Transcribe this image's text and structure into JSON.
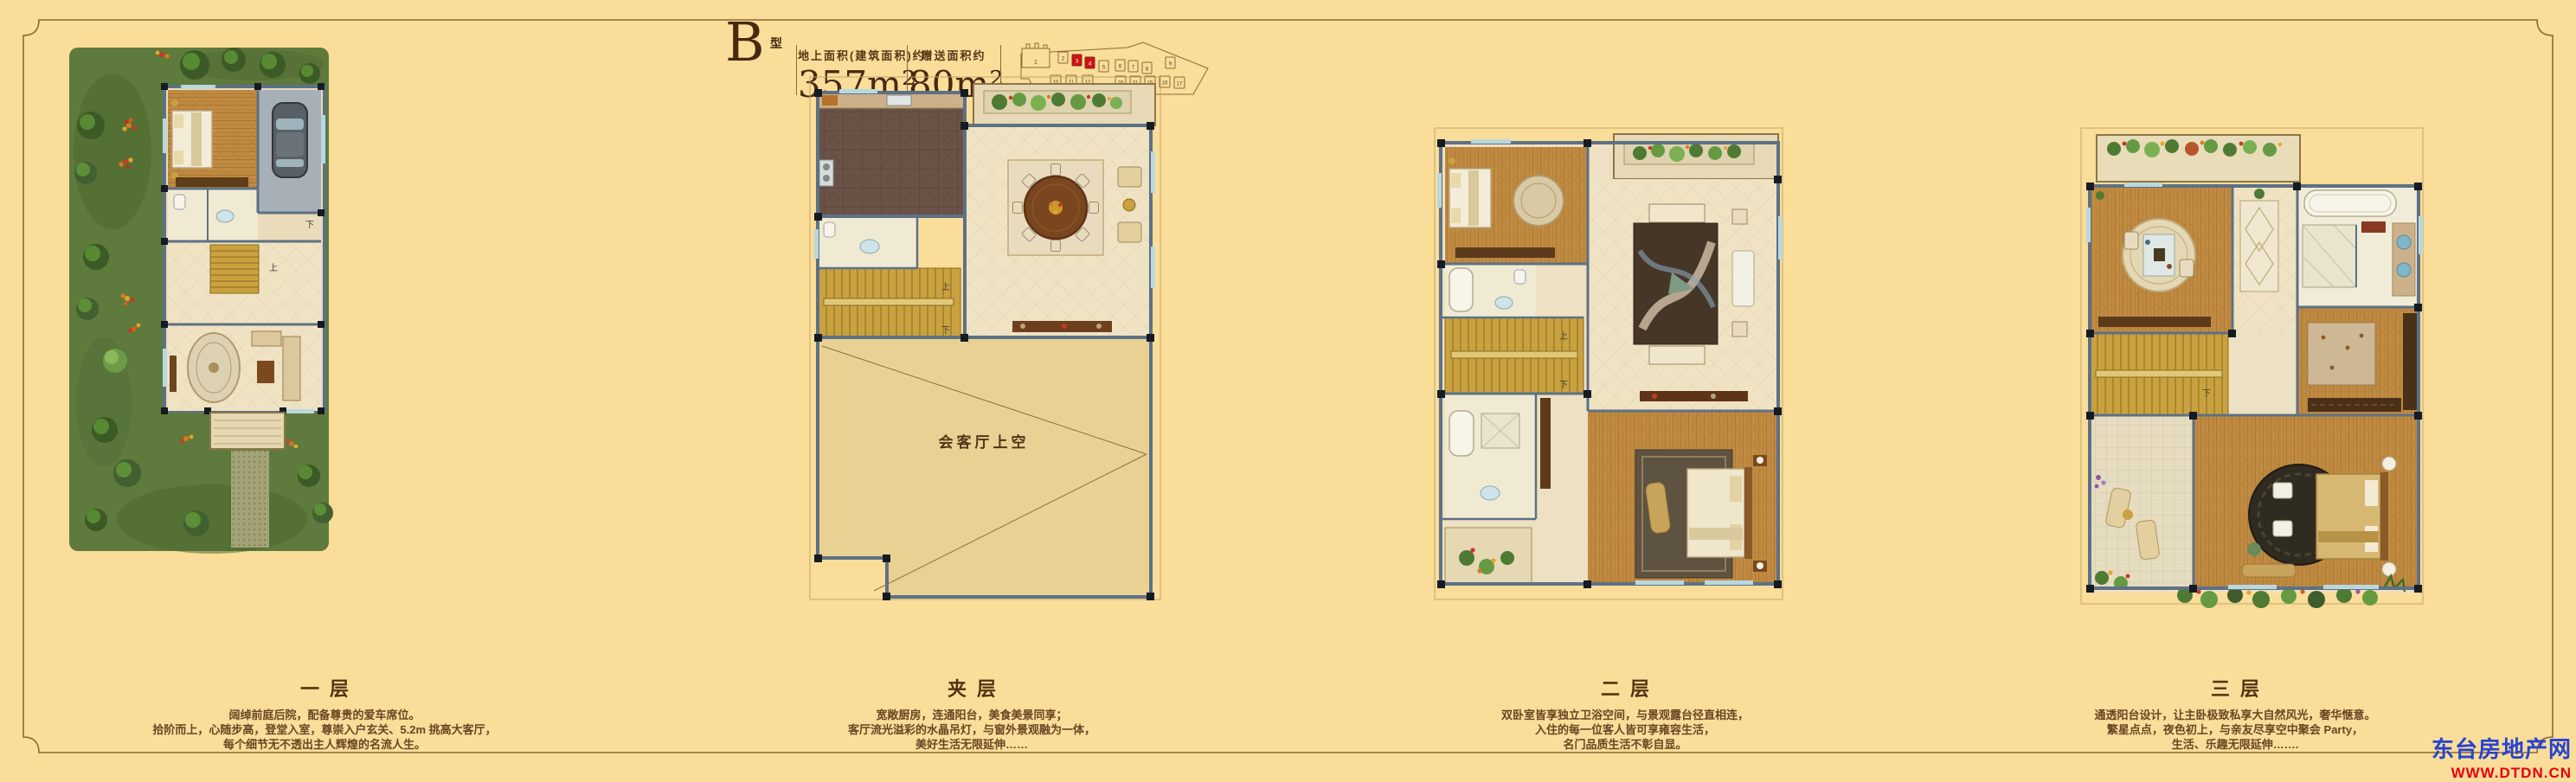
{
  "header": {
    "type_letter": "B",
    "type_suffix": "型",
    "area1_label": "地上面积(建筑面积)约",
    "area1_value": "357m²",
    "area2_label": "赠送面积约",
    "area2_value": "80m²"
  },
  "siteplan": {
    "highlight_color": "#cc1412",
    "units_top": [
      {
        "n": "1"
      },
      {
        "n": "2"
      },
      {
        "n": "3",
        "hl": true
      },
      {
        "n": "4",
        "hl": true
      },
      {
        "n": "5"
      },
      {
        "n": "6"
      },
      {
        "n": "7"
      },
      {
        "n": "8"
      },
      {
        "n": "9"
      }
    ],
    "units_bottom": [
      {
        "n": "10"
      },
      {
        "n": "11"
      },
      {
        "n": "12"
      },
      {
        "n": "20"
      },
      {
        "n": "21"
      },
      {
        "n": "15"
      },
      {
        "n": "16"
      },
      {
        "n": "17"
      }
    ]
  },
  "floors": [
    {
      "title": "一层",
      "desc": [
        "阔绰前庭后院，配备尊贵的爱车席位。",
        "拾阶而上，心随步高，登堂入室，尊崇入户玄关、5.2m 挑高大客厅，",
        "每个细节无不透出主人辉煌的名流人生。"
      ]
    },
    {
      "title": "夹层",
      "desc": [
        "宽敞厨房，连通阳台，美食美景同享；",
        "客厅流光溢彩的水晶吊灯，与窗外景观融为一体，",
        "美好生活无限延伸……"
      ]
    },
    {
      "title": "二层",
      "desc": [
        "双卧室皆享独立卫浴空间，与景观露台径直相连，",
        "入住的每一位客人皆可享雍容生活，",
        "名门品质生活不彰自显。"
      ]
    },
    {
      "title": "三层",
      "desc": [
        "通透阳台设计，让主卧极致私享大自然风光，奢华惬意。",
        "繁星点点，夜色初上，与亲友尽享空中聚会 Party，",
        "生活、乐趣无限延伸……."
      ]
    }
  ],
  "plan_annotations": {
    "void_label": "会客厅上空",
    "up": "上",
    "down": "下"
  },
  "watermark": {
    "site_name": "东台房地产网",
    "site_url": "WWW.DTDN.CN",
    "name_color": "#2743d0",
    "url_color": "#e60012"
  }
}
